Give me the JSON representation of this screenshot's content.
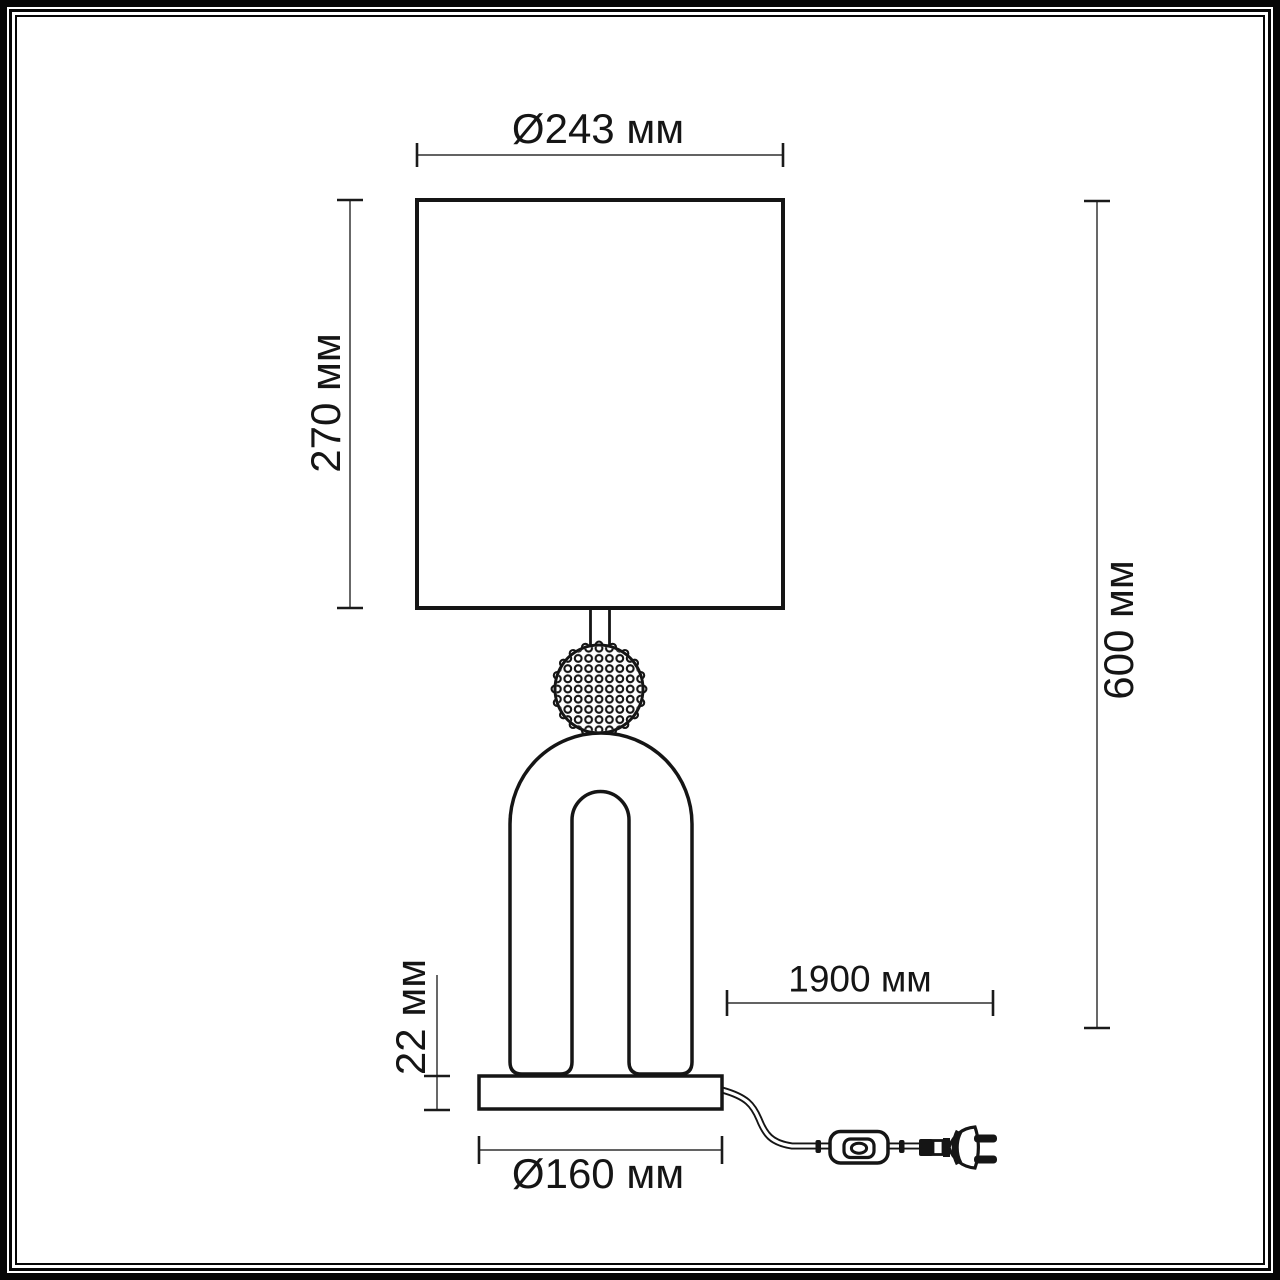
{
  "colors": {
    "ink": "#151515",
    "dimension_line": "#4d4d4d",
    "background": "#ffffff"
  },
  "diagram": {
    "type": "technical_dimension_drawing",
    "subject": "table-lamp",
    "units": "мм"
  },
  "dimensions": {
    "shade_diameter": {
      "label": "Ø243 мм",
      "value": 243,
      "orientation": "horizontal"
    },
    "shade_height": {
      "label": "270 мм",
      "value": 270,
      "orientation": "vertical"
    },
    "total_height": {
      "label": "600 мм",
      "value": 600,
      "orientation": "vertical"
    },
    "base_height": {
      "label": "22 мм",
      "value": 22,
      "orientation": "vertical"
    },
    "base_diameter": {
      "label": "Ø160 мм",
      "value": 160,
      "orientation": "horizontal"
    },
    "cord_length": {
      "label": "1900 мм",
      "value": 1900,
      "orientation": "horizontal"
    }
  }
}
